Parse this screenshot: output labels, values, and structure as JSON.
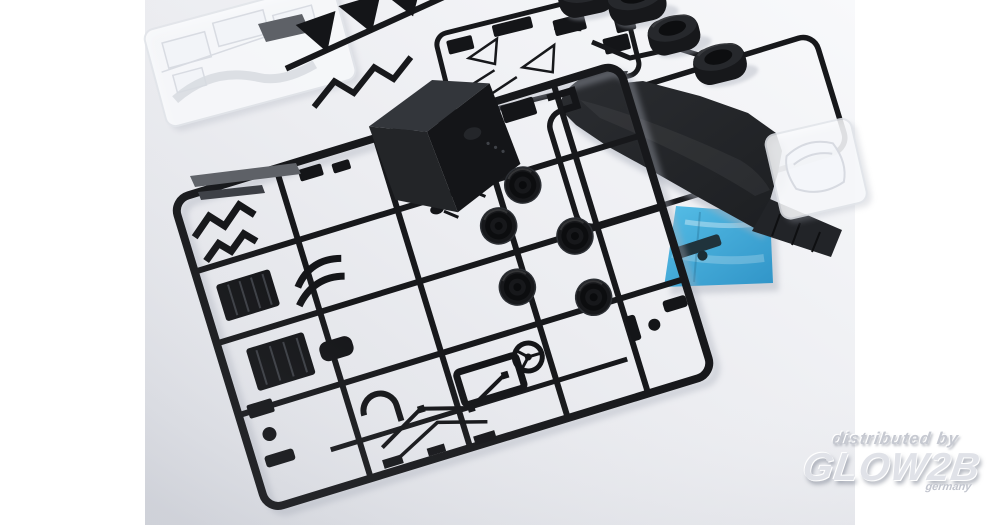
{
  "photo": {
    "subject": "Plastic scale model car kit sprues laid out on a light studio background",
    "items": [
      "main-parts-sprue",
      "clear-parts-sprue",
      "wing-parts-sprue",
      "suspension-parts-sprue",
      "chassis-sprue",
      "chassis-floor-plate",
      "slick-tires",
      "windscreen-bag",
      "blue-decal-film-bag",
      "cockpit-tub-part",
      "steering-wheel-part",
      "wheel-hub-parts"
    ],
    "tire_count": 4
  },
  "watermark": {
    "distributor_line": "distributed by",
    "brand": "GLOW2B",
    "country": "germany"
  },
  "colors": {
    "canvas": "#ffffff",
    "bg_top": "#f8f9fb",
    "bg_mid": "#ecedf1",
    "bg_bottom": "#dcdee4",
    "sprue_black": "#17181b",
    "part_black": "#141518",
    "part_mid": "#232528",
    "part_face": "#33363b",
    "gray_part": "#5e6167",
    "grid_line": "#3b3e44",
    "tire_side": "#17181b",
    "tire_face": "#26282c",
    "tire_hole": "#0d0e10",
    "plate_light": "#2b2d31",
    "plate_dark": "#1d1f22",
    "diffuser": "#222428",
    "film_light": "#4fbbe6",
    "film_dark": "#2a92c7",
    "film_part": "#20333c",
    "clear_fill": "#fafbfd",
    "clear_stroke": "#e2e5ea",
    "clear_detail": "#d7dae1",
    "shadow": "#a9aeba"
  }
}
